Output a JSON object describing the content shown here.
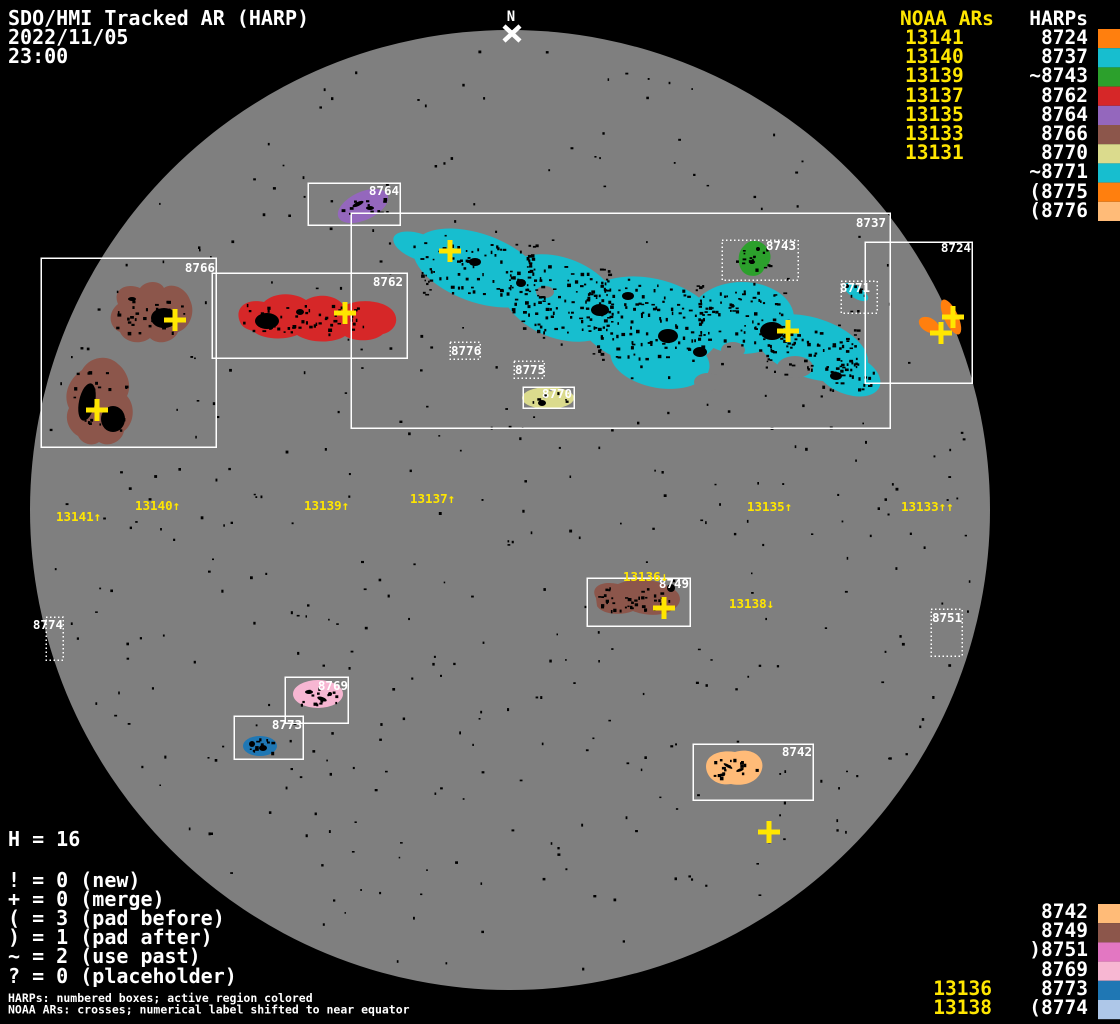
{
  "title": {
    "app": "SDO/HMI Tracked AR (HARP)",
    "date": "2022/11/05",
    "time": "23:00"
  },
  "north": {
    "label": "N"
  },
  "colors": {
    "background": "#000000",
    "disk_gray": "#7f7f7f",
    "label_white": "#ffffff",
    "noaa_yellow": "#ffe600"
  },
  "palette": {
    "8724": "#ff7f0e",
    "8737": "#17becf",
    "8742": "#ffbb78",
    "8743": "#2ca02c",
    "8749": "#8c564b",
    "8751": "#e377c2",
    "8762": "#d62728",
    "8764": "#9467bd",
    "8766": "#8c564b",
    "8769": "#f7b6d2",
    "8770": "#dbdb8d",
    "8771": "#17becf",
    "8773": "#1f77b4",
    "8774": "#aec7e8",
    "8775": "#ff7f0e",
    "8776": "#ffbb78"
  },
  "legend_top": {
    "noaa_header": "NOAA ARs",
    "harp_header": "HARPs",
    "noaa": [
      "13141",
      "13140",
      "13139",
      "13137",
      "13135",
      "13133",
      "13131"
    ],
    "harps": [
      "8724",
      "8737",
      "~8743",
      "8762",
      "8764",
      "8766",
      "8770",
      "~8771",
      "(8775",
      "(8776"
    ]
  },
  "legend_bottom": {
    "harps": [
      "8742",
      "8749",
      ")8751",
      "8769",
      "8773",
      "(8774"
    ],
    "noaa": [
      "13136",
      "13138"
    ]
  },
  "stats": {
    "harp_count": "H = 16",
    "flags": [
      "! = 0 (new)",
      "+ = 0 (merge)",
      "( = 3 (pad before)",
      ") = 1 (pad after)",
      "~ = 2 (use past)",
      "? = 0 (placeholder)"
    ]
  },
  "footnotes": [
    "HARPs: numbered boxes; active region colored",
    "NOAA ARs: crosses; numerical label shifted to near equator"
  ],
  "disk": {
    "boxes": [
      {
        "label": "8766"
      },
      {
        "label": "8762"
      },
      {
        "label": "8764"
      },
      {
        "label": "8737"
      },
      {
        "label": "8743"
      },
      {
        "label": "8771"
      },
      {
        "label": "8724"
      },
      {
        "label": "8776"
      },
      {
        "label": "8775"
      },
      {
        "label": "8770"
      },
      {
        "label": "8749"
      },
      {
        "label": "8751"
      },
      {
        "label": "8769"
      },
      {
        "label": "8773"
      },
      {
        "label": "8742"
      },
      {
        "label": "8774"
      }
    ],
    "noaa_labels": [
      "13141↑",
      "13140↑",
      "13139↑",
      "13137↑",
      "13135↑",
      "13133↑↑",
      "13136↓",
      "13138↓"
    ]
  }
}
